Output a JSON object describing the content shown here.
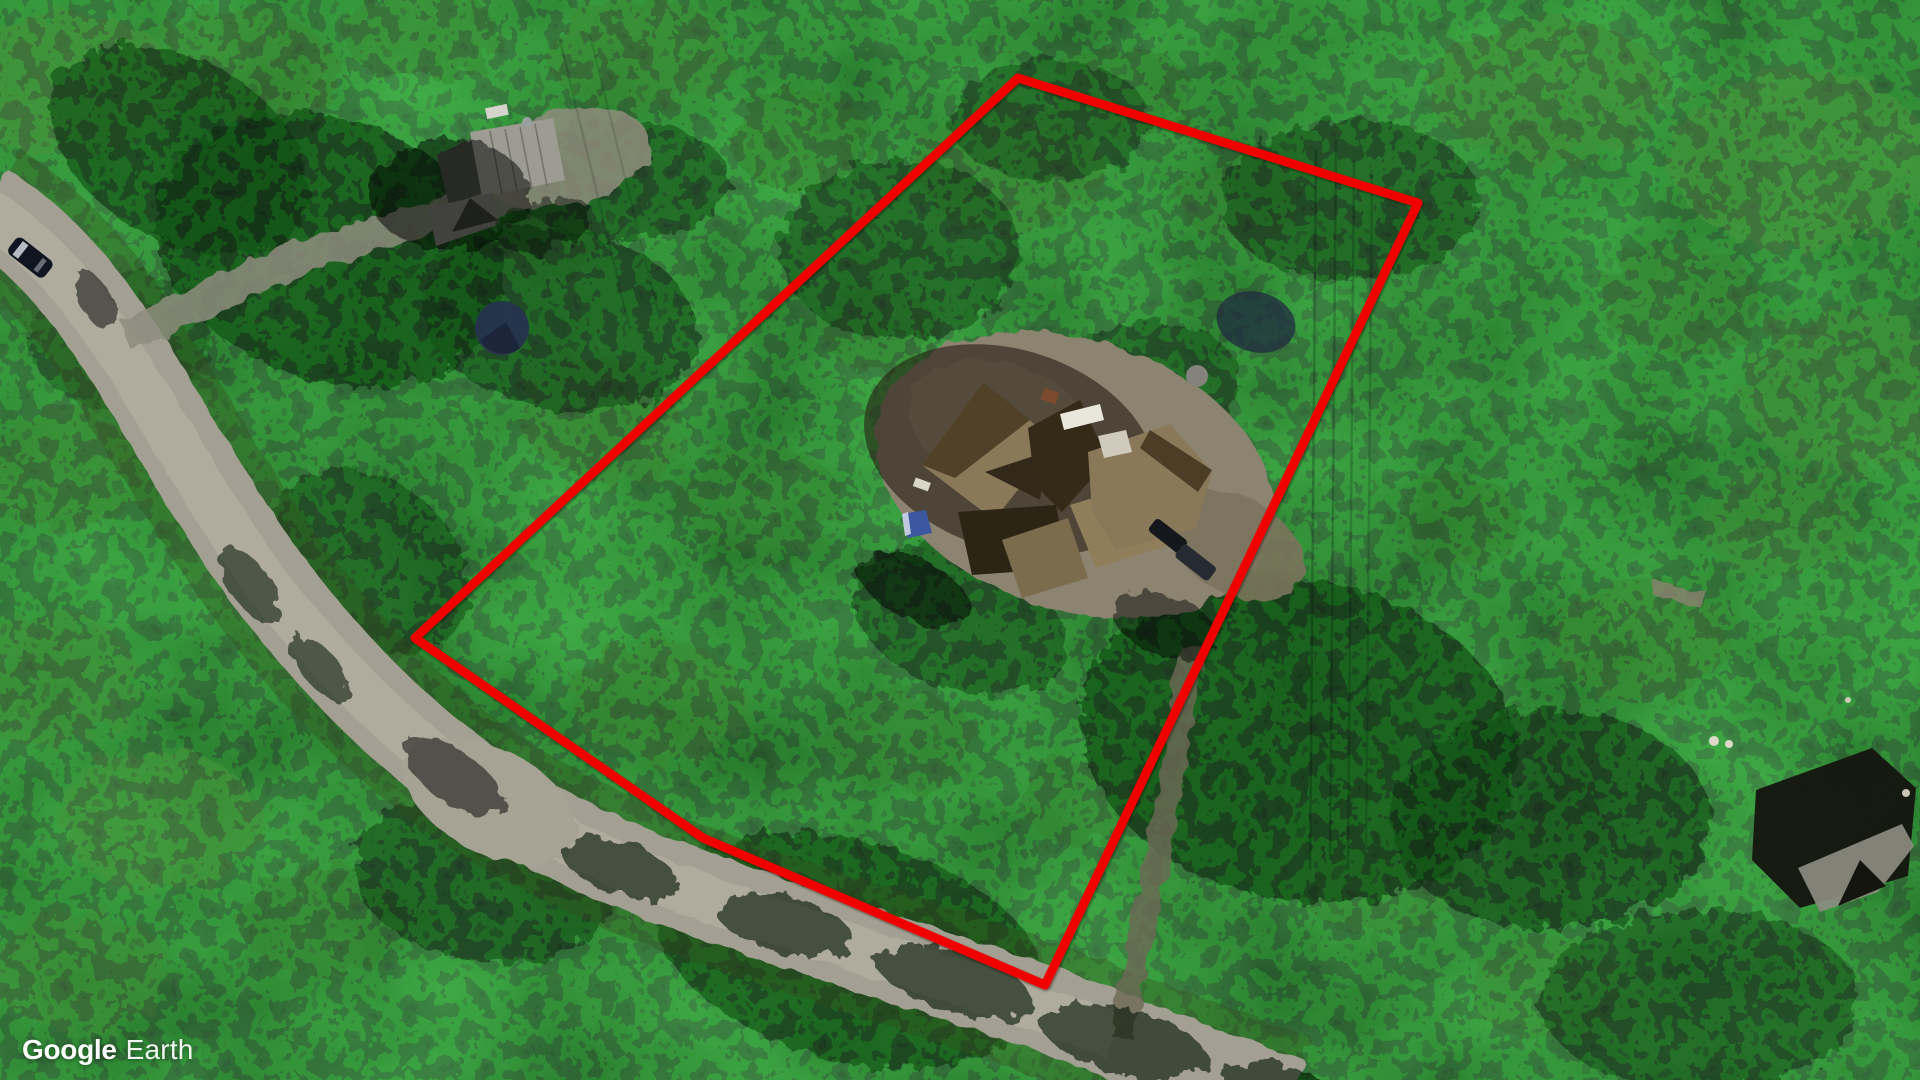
{
  "watermark": {
    "brand": "Google",
    "product": "Earth"
  },
  "overlay": {
    "property_boundary": {
      "color": "#f10000",
      "stroke_width": 9,
      "points": "1018,78 1418,203 1045,985 703,838 415,638"
    }
  }
}
